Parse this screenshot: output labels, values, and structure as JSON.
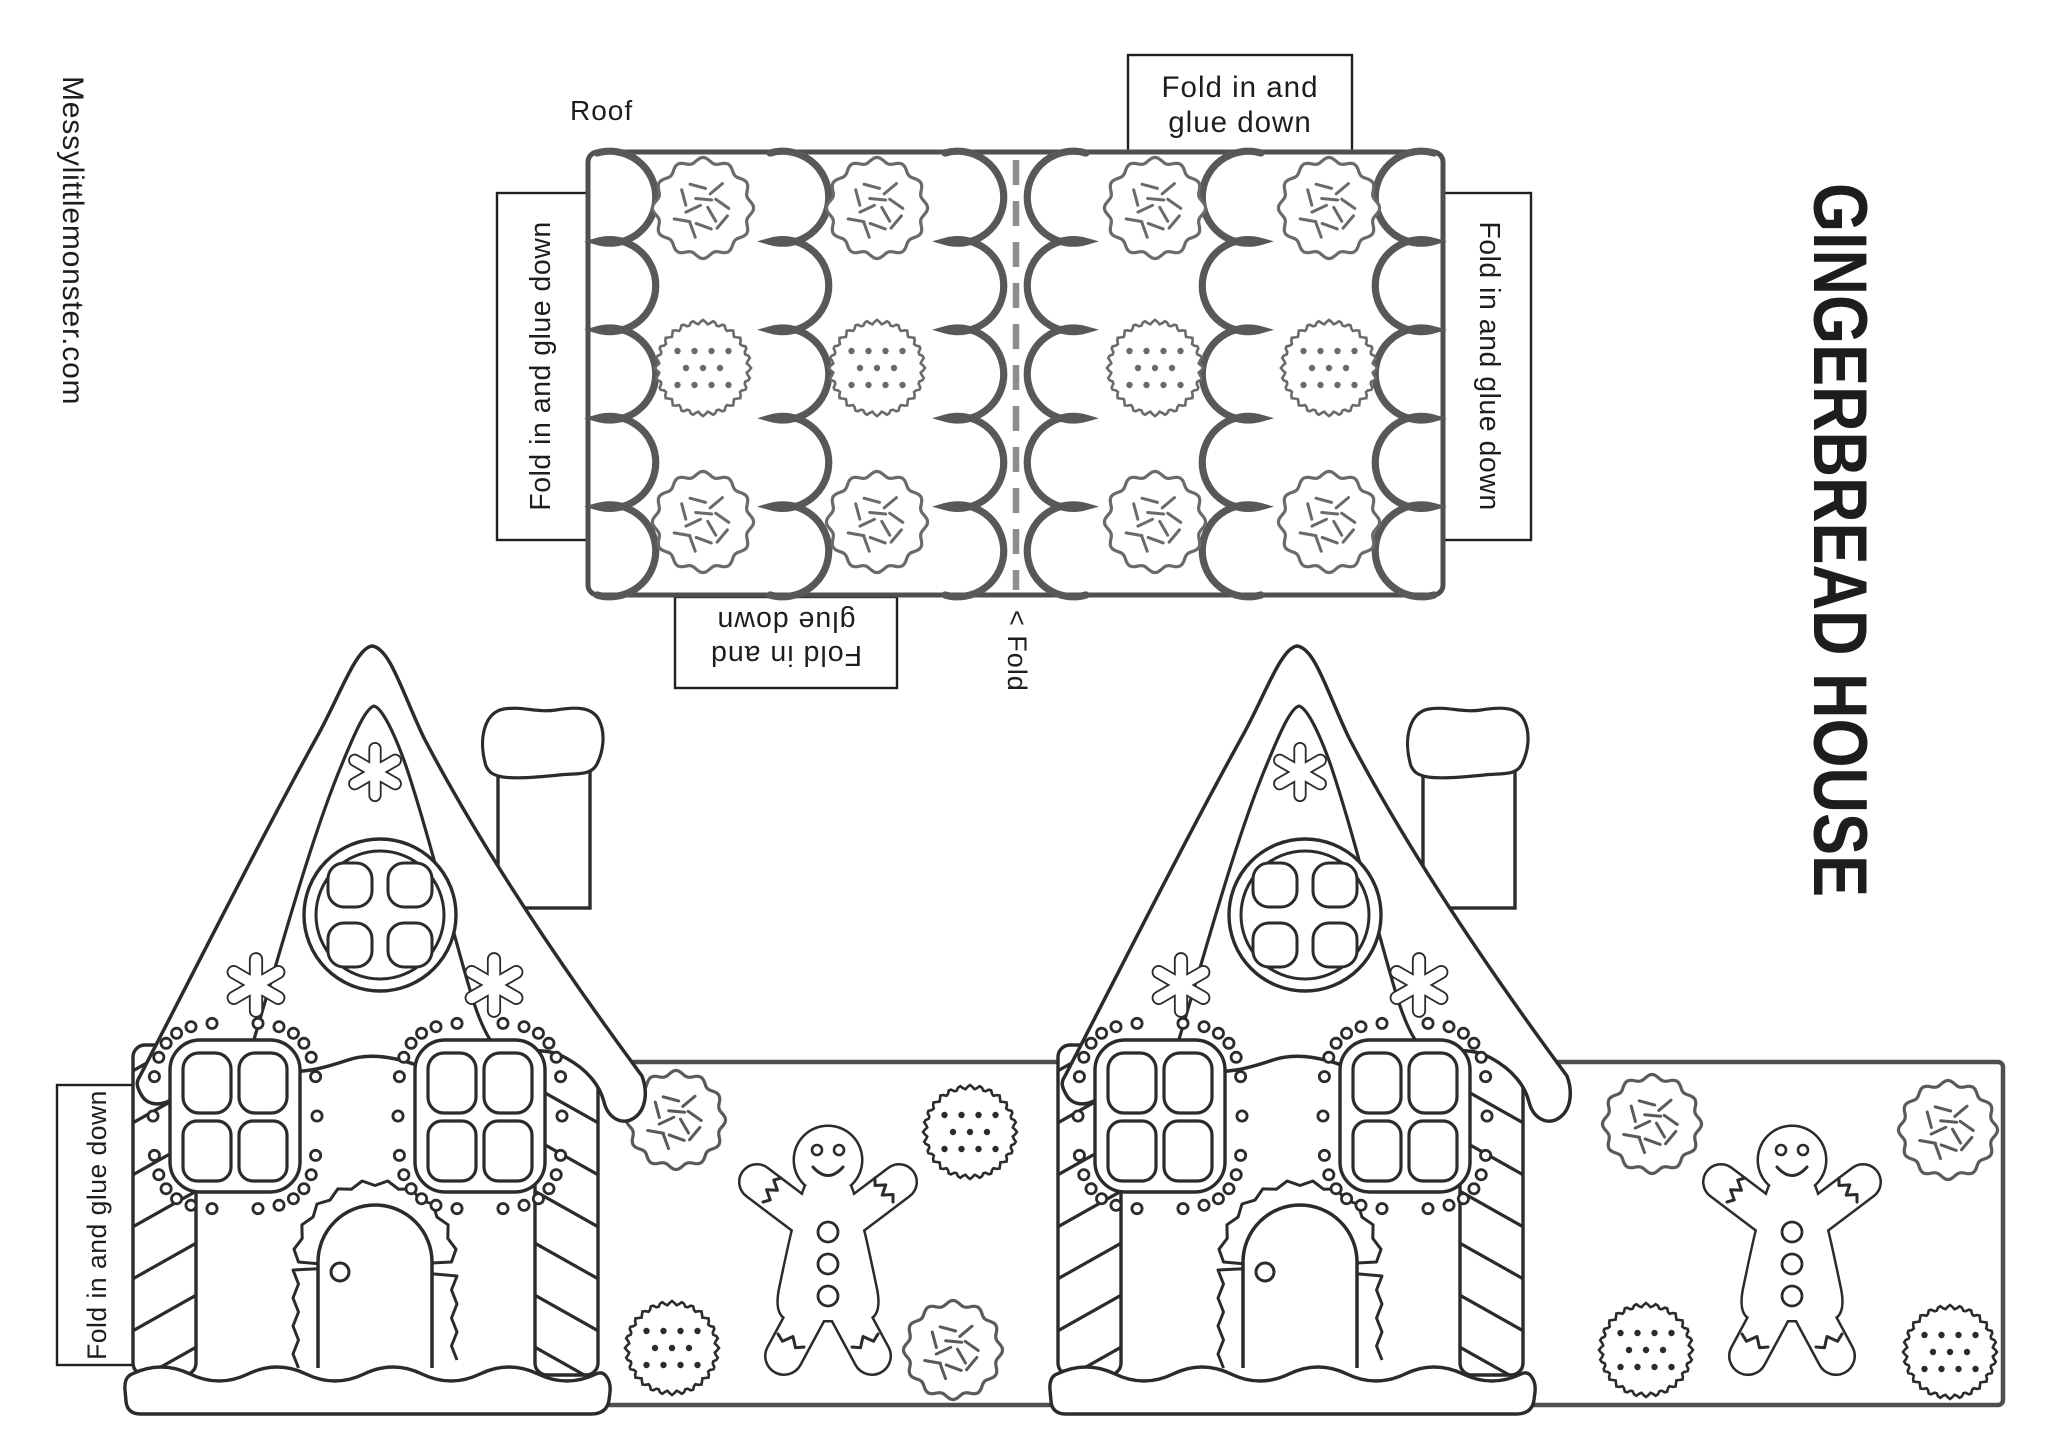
{
  "watermark": "Messylittlemonster.com",
  "title": "GINGERBREAD HOUSE",
  "roof": {
    "label": "Roof",
    "fold_marker": "< Fold",
    "tab_top_line1": "Fold in and",
    "tab_top_line2": "glue  down",
    "tab_left": "Fold in and glue  down",
    "tab_right": "Fold in and glue  down",
    "tab_bottom_line1": "Fold in and",
    "tab_bottom_line2": "glue  down"
  },
  "house": {
    "tab_left": "Fold in and glue  down"
  },
  "colors": {
    "ink": "#2b2b2b",
    "panel_border": "#4f4f4f",
    "scallop_icing": "#585858",
    "roof_cookie_line": "#6a6a6a",
    "fold_dash": "#8d8d8d",
    "label_text": "#1d1d1d"
  }
}
